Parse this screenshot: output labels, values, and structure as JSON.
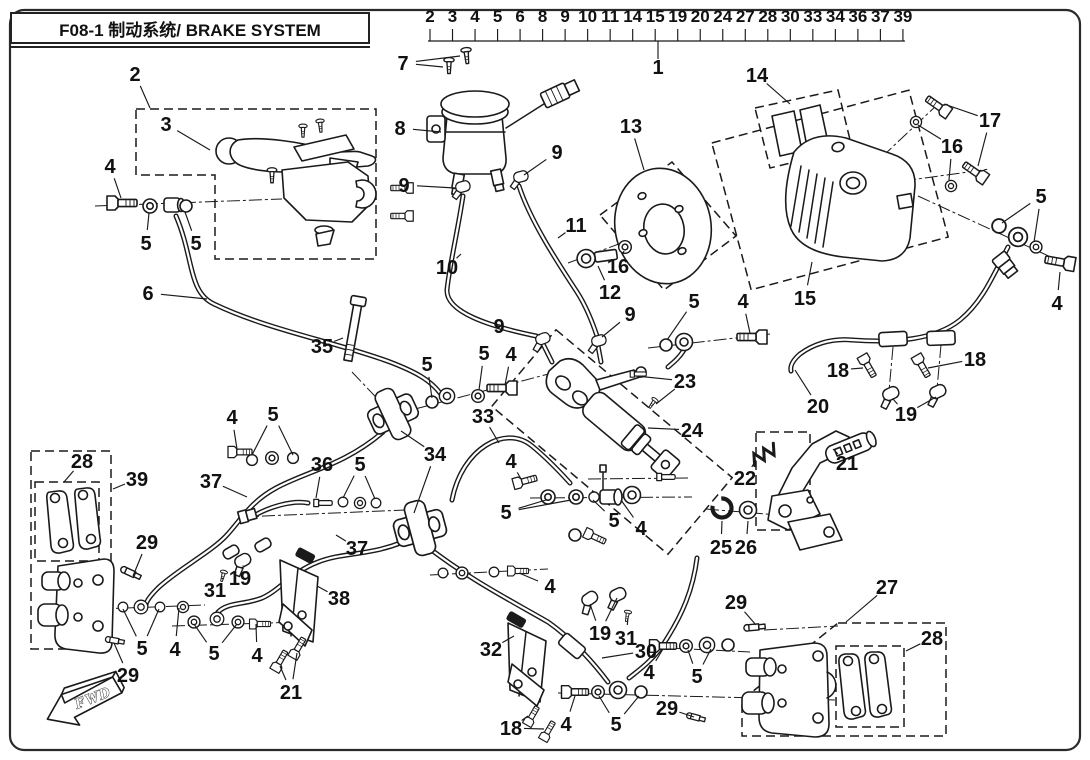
{
  "title": {
    "full": "F08-1 制动系统/ BRAKE SYSTEM"
  },
  "index_strip": {
    "numbers": [
      "2",
      "3",
      "4",
      "5",
      "6",
      "8",
      "9",
      "10",
      "11",
      "14",
      "15",
      "19",
      "20",
      "24",
      "27",
      "28",
      "30",
      "33",
      "34",
      "36",
      "37",
      "39"
    ],
    "pointer_label": "1"
  },
  "fwd_marker": {
    "label": "FWD"
  },
  "colors": {
    "line": "#1a1a1a",
    "background": "#ffffff"
  },
  "callouts": [
    {
      "label": "2",
      "x": 135,
      "y": 74,
      "targets": [
        [
          150,
          108
        ]
      ]
    },
    {
      "label": "3",
      "x": 166,
      "y": 124,
      "targets": [
        [
          210,
          150
        ]
      ]
    },
    {
      "label": "4",
      "x": 110,
      "y": 166,
      "targets": [
        [
          121,
          198
        ]
      ]
    },
    {
      "label": "5",
      "x": 146,
      "y": 243,
      "targets": [
        [
          149,
          213
        ]
      ]
    },
    {
      "label": "5",
      "x": 196,
      "y": 243,
      "targets": [
        [
          185,
          212
        ]
      ]
    },
    {
      "label": "6",
      "x": 148,
      "y": 293,
      "targets": [
        [
          207,
          299
        ]
      ]
    },
    {
      "label": "7",
      "x": 403,
      "y": 63,
      "targets": [
        [
          443,
          67
        ],
        [
          460,
          56
        ]
      ]
    },
    {
      "label": "8",
      "x": 400,
      "y": 128,
      "targets": [
        [
          441,
          132
        ]
      ]
    },
    {
      "label": "9",
      "x": 404,
      "y": 185,
      "targets": [
        [
          455,
          188
        ]
      ]
    },
    {
      "label": "9",
      "x": 557,
      "y": 152,
      "targets": [
        [
          524,
          175
        ]
      ]
    },
    {
      "label": "10",
      "x": 447,
      "y": 267,
      "targets": [
        [
          461,
          254
        ]
      ]
    },
    {
      "label": "11",
      "x": 576,
      "y": 225,
      "targets": [
        [
          558,
          238
        ]
      ]
    },
    {
      "label": "12",
      "x": 610,
      "y": 292,
      "targets": [
        [
          598,
          266
        ]
      ]
    },
    {
      "label": "13",
      "x": 631,
      "y": 126,
      "targets": [
        [
          644,
          170
        ]
      ]
    },
    {
      "label": "16",
      "x": 618,
      "y": 266,
      "targets": [
        [
          624,
          251
        ]
      ]
    },
    {
      "label": "14",
      "x": 757,
      "y": 75,
      "targets": [
        [
          790,
          104
        ]
      ]
    },
    {
      "label": "15",
      "x": 805,
      "y": 298,
      "targets": [
        [
          812,
          262
        ]
      ]
    },
    {
      "label": "16",
      "x": 952,
      "y": 146,
      "targets": [
        [
          918,
          125
        ],
        [
          949,
          180
        ]
      ]
    },
    {
      "label": "17",
      "x": 990,
      "y": 120,
      "targets": [
        [
          944,
          104
        ],
        [
          978,
          166
        ]
      ]
    },
    {
      "label": "5",
      "x": 1041,
      "y": 196,
      "targets": [
        [
          1002,
          223
        ],
        [
          1034,
          242
        ]
      ]
    },
    {
      "label": "4",
      "x": 1057,
      "y": 303,
      "targets": [
        [
          1060,
          272
        ]
      ]
    },
    {
      "label": "18",
      "x": 838,
      "y": 370,
      "targets": [
        [
          863,
          368
        ]
      ]
    },
    {
      "label": "18",
      "x": 975,
      "y": 359,
      "targets": [
        [
          928,
          368
        ]
      ]
    },
    {
      "label": "19",
      "x": 906,
      "y": 414,
      "targets": [
        [
          893,
          399
        ],
        [
          936,
          397
        ]
      ]
    },
    {
      "label": "20",
      "x": 818,
      "y": 406,
      "targets": [
        [
          795,
          370
        ]
      ]
    },
    {
      "label": "35",
      "x": 322,
      "y": 346,
      "targets": [
        [
          343,
          338
        ]
      ]
    },
    {
      "label": "5",
      "x": 427,
      "y": 364,
      "targets": [
        [
          432,
          398
        ]
      ]
    },
    {
      "label": "5",
      "x": 484,
      "y": 353,
      "targets": [
        [
          479,
          390
        ]
      ]
    },
    {
      "label": "4",
      "x": 511,
      "y": 354,
      "targets": [
        [
          505,
          385
        ]
      ]
    },
    {
      "label": "9",
      "x": 499,
      "y": 326,
      "targets": [
        [
          540,
          335
        ]
      ]
    },
    {
      "label": "9",
      "x": 630,
      "y": 314,
      "targets": [
        [
          602,
          337
        ]
      ]
    },
    {
      "label": "5",
      "x": 694,
      "y": 301,
      "targets": [
        [
          667,
          340
        ]
      ]
    },
    {
      "label": "4",
      "x": 743,
      "y": 301,
      "targets": [
        [
          750,
          333
        ]
      ]
    },
    {
      "label": "23",
      "x": 685,
      "y": 381,
      "targets": [
        [
          636,
          376
        ],
        [
          656,
          404
        ]
      ]
    },
    {
      "label": "24",
      "x": 692,
      "y": 430,
      "targets": [
        [
          648,
          428
        ]
      ]
    },
    {
      "label": "33",
      "x": 483,
      "y": 416,
      "targets": [
        [
          499,
          443
        ]
      ]
    },
    {
      "label": "34",
      "x": 435,
      "y": 454,
      "targets": [
        [
          401,
          431
        ],
        [
          414,
          513
        ]
      ]
    },
    {
      "label": "4",
      "x": 232,
      "y": 417,
      "targets": [
        [
          237,
          449
        ]
      ]
    },
    {
      "label": "5",
      "x": 273,
      "y": 414,
      "targets": [
        [
          252,
          455
        ],
        [
          293,
          455
        ]
      ]
    },
    {
      "label": "36",
      "x": 322,
      "y": 464,
      "targets": [
        [
          316,
          498
        ]
      ]
    },
    {
      "label": "5",
      "x": 360,
      "y": 464,
      "targets": [
        [
          343,
          498
        ],
        [
          375,
          499
        ]
      ]
    },
    {
      "label": "37",
      "x": 211,
      "y": 481,
      "targets": [
        [
          247,
          497
        ]
      ]
    },
    {
      "label": "37",
      "x": 357,
      "y": 548,
      "targets": [
        [
          336,
          535
        ]
      ]
    },
    {
      "label": "28",
      "x": 82,
      "y": 461,
      "targets": [
        [
          64,
          482
        ]
      ]
    },
    {
      "label": "39",
      "x": 137,
      "y": 479,
      "targets": [
        [
          113,
          489
        ]
      ]
    },
    {
      "label": "29",
      "x": 147,
      "y": 542,
      "targets": [
        [
          133,
          576
        ]
      ]
    },
    {
      "label": "19",
      "x": 240,
      "y": 578,
      "targets": [
        [
          243,
          566
        ]
      ]
    },
    {
      "label": "31",
      "x": 215,
      "y": 590,
      "targets": [
        [
          223,
          578
        ]
      ]
    },
    {
      "label": "38",
      "x": 339,
      "y": 598,
      "targets": [
        [
          317,
          586
        ]
      ]
    },
    {
      "label": "21",
      "x": 847,
      "y": 463,
      "targets": [
        [
          833,
          449
        ]
      ]
    },
    {
      "label": "22",
      "x": 745,
      "y": 478,
      "targets": [
        [
          756,
          460
        ]
      ]
    },
    {
      "label": "25",
      "x": 721,
      "y": 547,
      "targets": [
        [
          722,
          521
        ]
      ]
    },
    {
      "label": "26",
      "x": 746,
      "y": 547,
      "targets": [
        [
          748,
          521
        ]
      ]
    },
    {
      "label": "5",
      "x": 142,
      "y": 648,
      "targets": [
        [
          123,
          609
        ],
        [
          159,
          609
        ]
      ]
    },
    {
      "label": "4",
      "x": 175,
      "y": 649,
      "targets": [
        [
          179,
          608
        ]
      ]
    },
    {
      "label": "5",
      "x": 214,
      "y": 653,
      "targets": [
        [
          194,
          624
        ],
        [
          237,
          624
        ]
      ]
    },
    {
      "label": "4",
      "x": 257,
      "y": 655,
      "targets": [
        [
          256,
          624
        ]
      ]
    },
    {
      "label": "29",
      "x": 128,
      "y": 675,
      "targets": [
        [
          114,
          643
        ]
      ]
    },
    {
      "label": "21",
      "x": 291,
      "y": 692,
      "targets": [
        [
          280,
          666
        ],
        [
          297,
          653
        ]
      ]
    },
    {
      "label": "32",
      "x": 491,
      "y": 649,
      "targets": [
        [
          514,
          636
        ]
      ]
    },
    {
      "label": "19",
      "x": 600,
      "y": 633,
      "targets": [
        [
          590,
          604
        ],
        [
          617,
          598
        ]
      ]
    },
    {
      "label": "31",
      "x": 626,
      "y": 638,
      "targets": [
        [
          628,
          618
        ]
      ]
    },
    {
      "label": "30",
      "x": 646,
      "y": 651,
      "targets": [
        [
          602,
          658
        ]
      ]
    },
    {
      "label": "4",
      "x": 550,
      "y": 586,
      "targets": [
        [
          519,
          573
        ]
      ]
    },
    {
      "label": "4",
      "x": 649,
      "y": 672,
      "targets": [
        [
          663,
          649
        ]
      ]
    },
    {
      "label": "5",
      "x": 697,
      "y": 676,
      "targets": [
        [
          688,
          650
        ],
        [
          711,
          649
        ]
      ]
    },
    {
      "label": "29",
      "x": 667,
      "y": 708,
      "targets": [
        [
          694,
          717
        ]
      ]
    },
    {
      "label": "4",
      "x": 566,
      "y": 724,
      "targets": [
        [
          575,
          696
        ]
      ]
    },
    {
      "label": "5",
      "x": 616,
      "y": 724,
      "targets": [
        [
          599,
          696
        ],
        [
          639,
          696
        ]
      ]
    },
    {
      "label": "18",
      "x": 511,
      "y": 728,
      "targets": [
        [
          528,
          716
        ],
        [
          544,
          729
        ]
      ]
    },
    {
      "label": "29",
      "x": 736,
      "y": 602,
      "targets": [
        [
          756,
          625
        ]
      ]
    },
    {
      "label": "27",
      "x": 887,
      "y": 587,
      "targets": [
        [
          846,
          622
        ]
      ]
    },
    {
      "label": "28",
      "x": 932,
      "y": 638,
      "targets": [
        [
          906,
          651
        ]
      ]
    },
    {
      "label": "5",
      "x": 506,
      "y": 512,
      "targets": [
        [
          546,
          500
        ],
        [
          571,
          500
        ]
      ]
    },
    {
      "label": "5",
      "x": 614,
      "y": 520,
      "targets": [
        [
          593,
          500
        ]
      ]
    },
    {
      "label": "4",
      "x": 641,
      "y": 528,
      "targets": [
        [
          621,
          500
        ]
      ]
    },
    {
      "label": "4",
      "x": 511,
      "y": 461,
      "targets": [
        [
          521,
          479
        ]
      ]
    }
  ]
}
